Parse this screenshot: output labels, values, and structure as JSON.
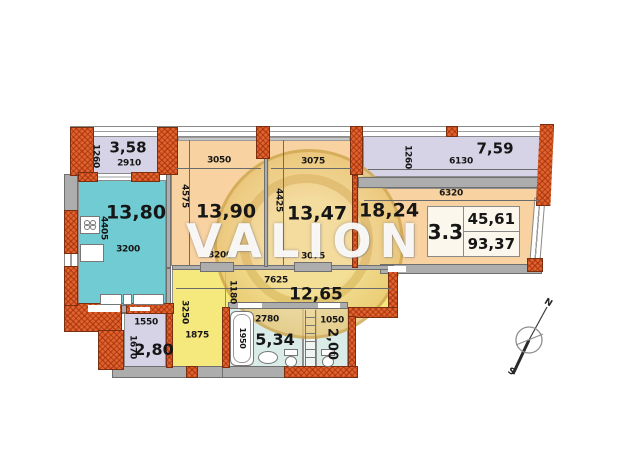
{
  "watermark": {
    "text": "VALION"
  },
  "info_box": {
    "unit": "3.3",
    "value_top": "45,61",
    "value_bottom": "93,37"
  },
  "compass": {
    "north": "N",
    "south": "S"
  },
  "rooms": {
    "balcony_left": {
      "area": "3,58",
      "dim_w": "2910",
      "dim_h": "1260"
    },
    "kitchen": {
      "area": "13,80",
      "dim_w": "3200",
      "dim_h": "4405"
    },
    "bedroom1": {
      "area": "13,90",
      "dim_top": "3050",
      "dim_h": "4575",
      "dim_bottom": "3200"
    },
    "bedroom2": {
      "area": "13,47",
      "dim_top": "3075",
      "dim_h": "4425",
      "dim_bottom": "3075"
    },
    "balcony_right": {
      "area": "7,59",
      "dim_w": "6130",
      "dim_h": "1260"
    },
    "living": {
      "area": "18,24",
      "dim_top": "6320"
    },
    "corridor": {
      "area": "12,65",
      "dim_top": "7625",
      "dim_h": "1180",
      "arm_h": "3250",
      "arm_w": "1875"
    },
    "storage": {
      "area": "2,80",
      "dim_w": "1550",
      "dim_h": "1670"
    },
    "bathroom": {
      "area": "5,34",
      "dim_w": "2780",
      "dim_tub": "1950"
    },
    "wc": {
      "area": "2,00",
      "dim_w": "1050"
    }
  },
  "colors": {
    "room_peach": "#f8d2a0",
    "room_lavender": "#d7d3e7",
    "room_teal": "#70cbd2",
    "room_yellow": "#f5e87c",
    "room_bath": "#daece8",
    "wall_orange": "#e0622c",
    "wall_gray": "#adadad",
    "watermark_tan": "#e8c678"
  }
}
